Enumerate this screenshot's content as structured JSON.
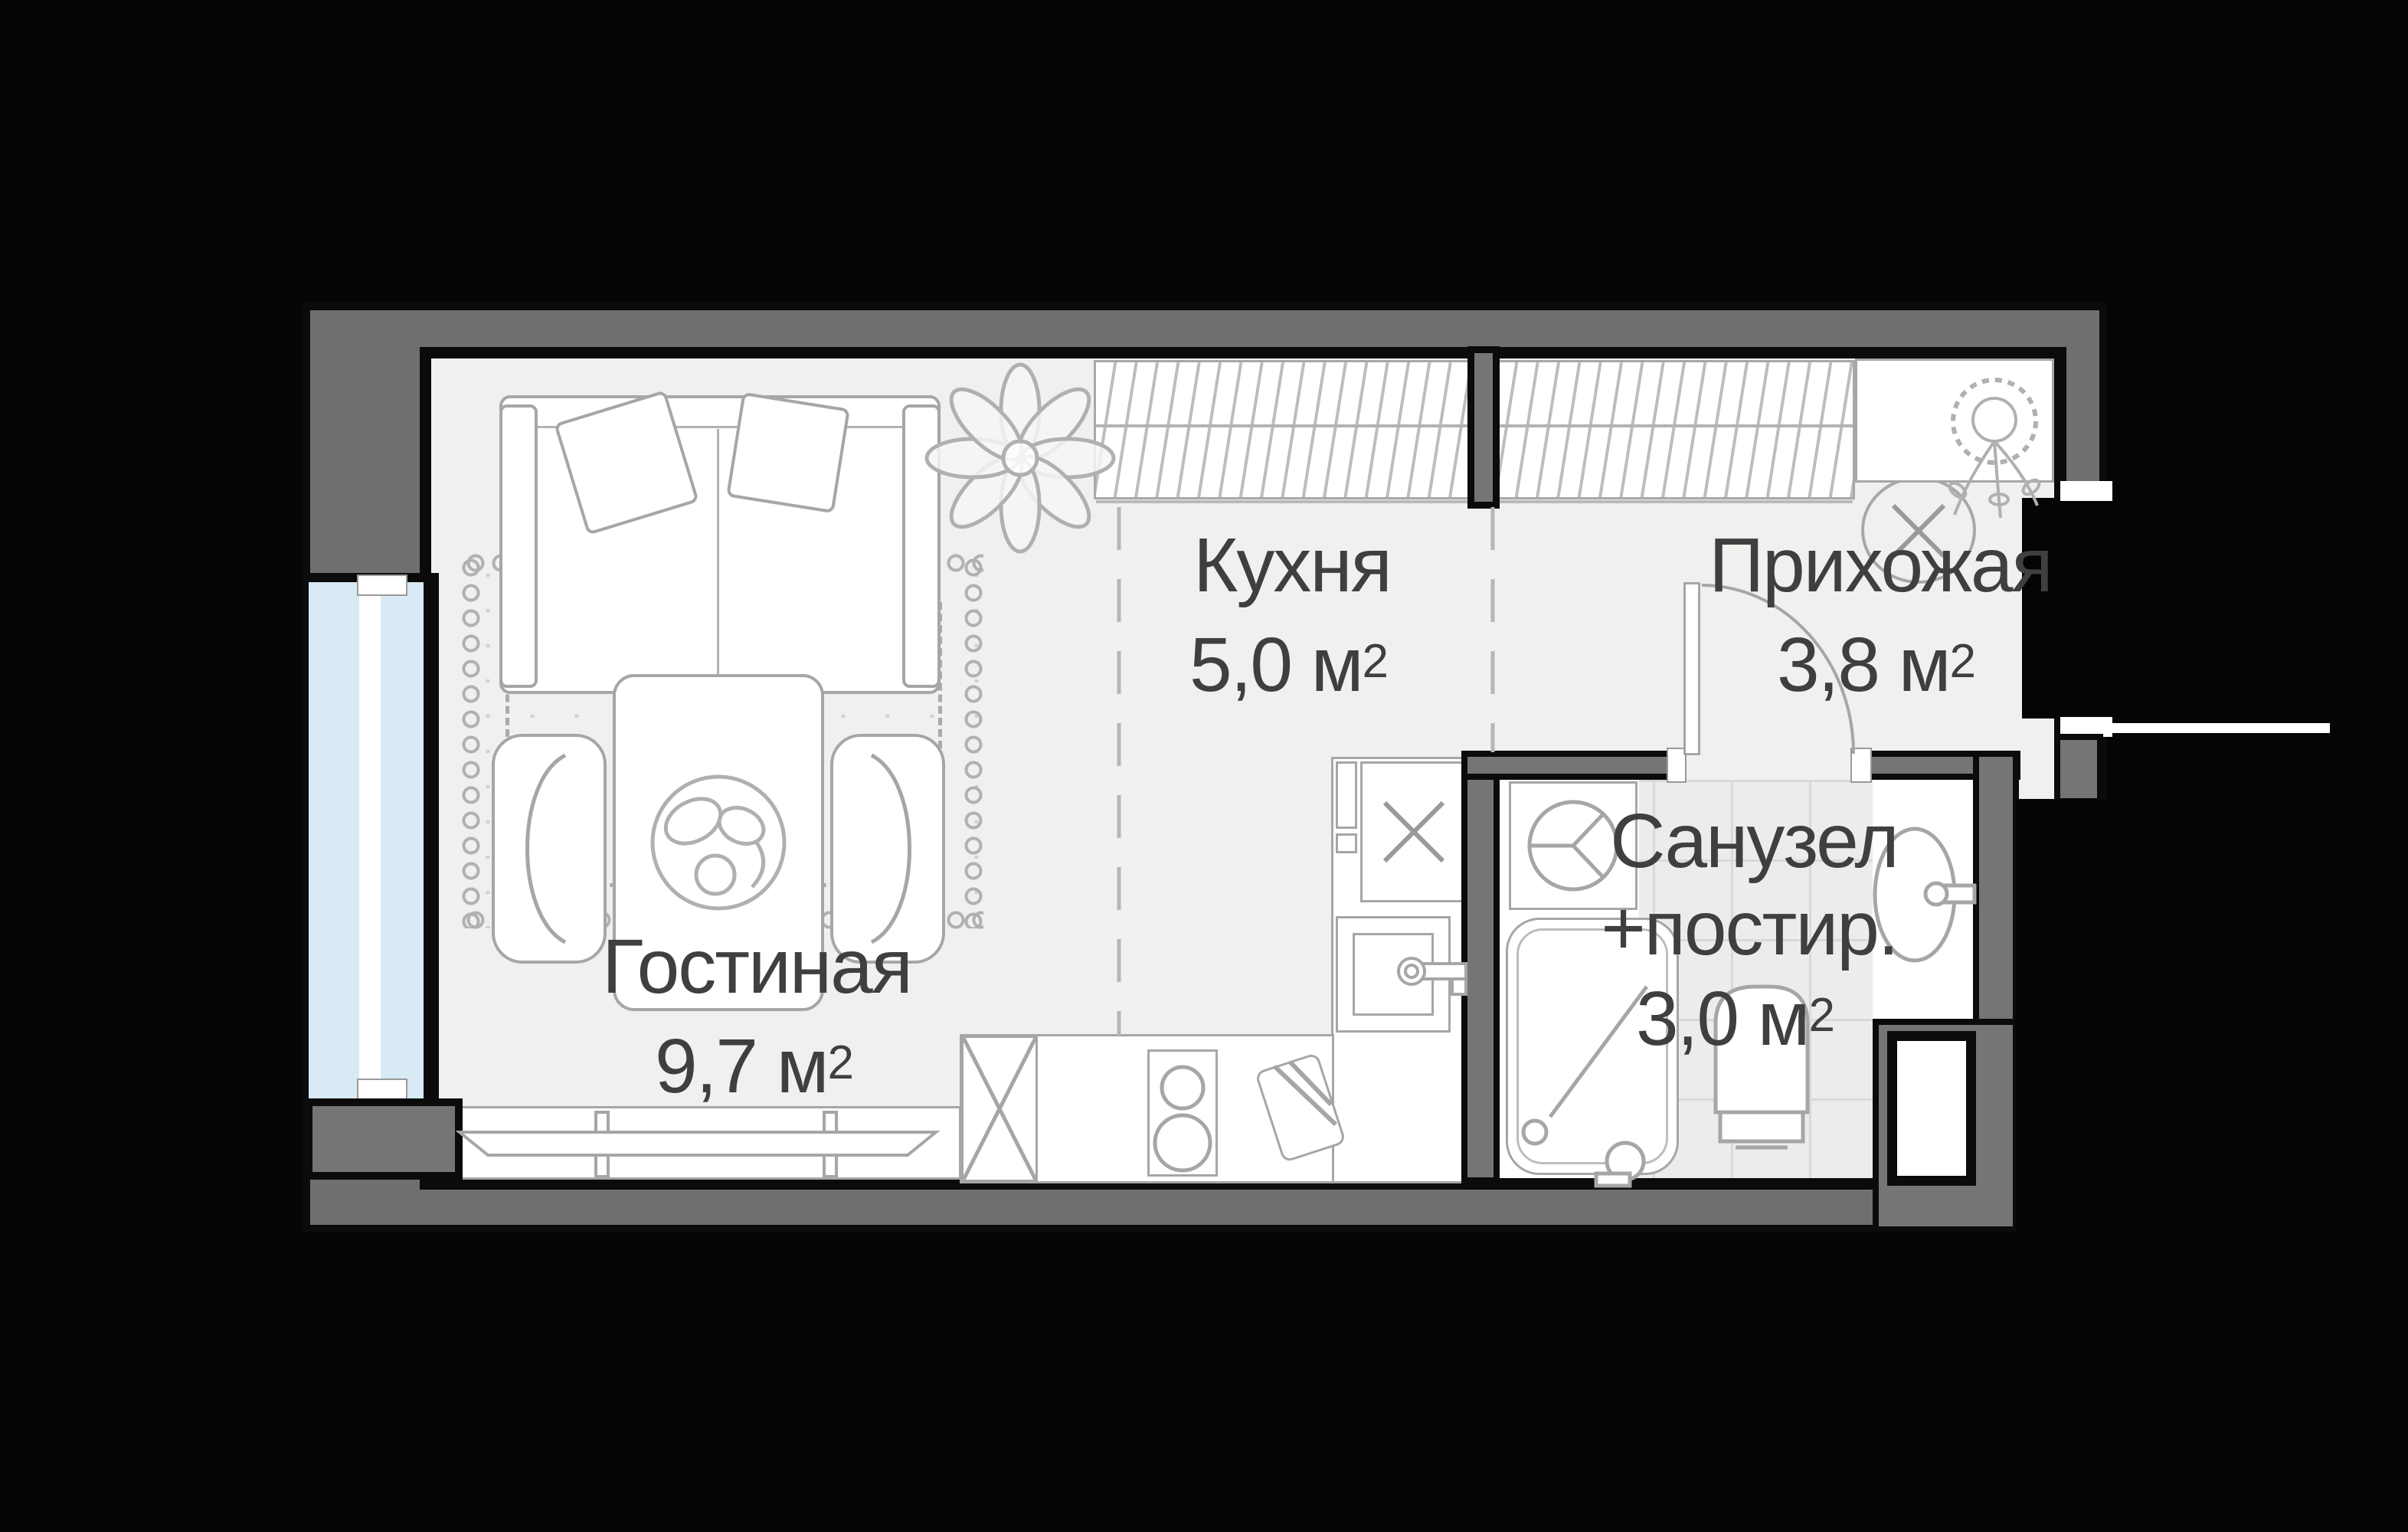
{
  "plan": {
    "rooms": [
      {
        "name": "Гостиная",
        "area": "9,7 м",
        "area_sup": "2"
      },
      {
        "name": "Кухня",
        "area": "5,0 м",
        "area_sup": "2"
      },
      {
        "name": "Прихожая",
        "area": "3,8 м",
        "area_sup": "2"
      },
      {
        "name": "Санузел",
        "name_line2": "+постир.",
        "area": "3,0 м",
        "area_sup": "2"
      }
    ],
    "colors": {
      "outside": "#050505",
      "wall_fill": "#6f6f6f",
      "wall_outline": "#0b0b0b",
      "floor": "#f1f0ee",
      "furniture_stroke": "#a6a6a6",
      "window_glass": "#d8eaf3",
      "tile": "#ececec",
      "label_text": "#3f3f3f"
    },
    "icons": [
      "sofa-icon",
      "pillow-icon",
      "plant-icon",
      "rug-icon",
      "dining-table-icon",
      "fruit-bowl-icon",
      "chair-icon",
      "tv-stand-icon",
      "tv-icon",
      "wardrobe-icon",
      "shelf-icon",
      "hanging-plant-icon",
      "ceiling-light-icon",
      "door-arc-icon",
      "kitchen-counter-icon",
      "fridge-cross-icon",
      "stove-icon",
      "cutting-board-icon",
      "kitchen-sink-icon",
      "vent-cross-icon",
      "washing-machine-icon",
      "shower-icon",
      "toilet-icon",
      "bathroom-sink-icon",
      "duct-icon",
      "window-icon",
      "entrance-opening"
    ]
  }
}
